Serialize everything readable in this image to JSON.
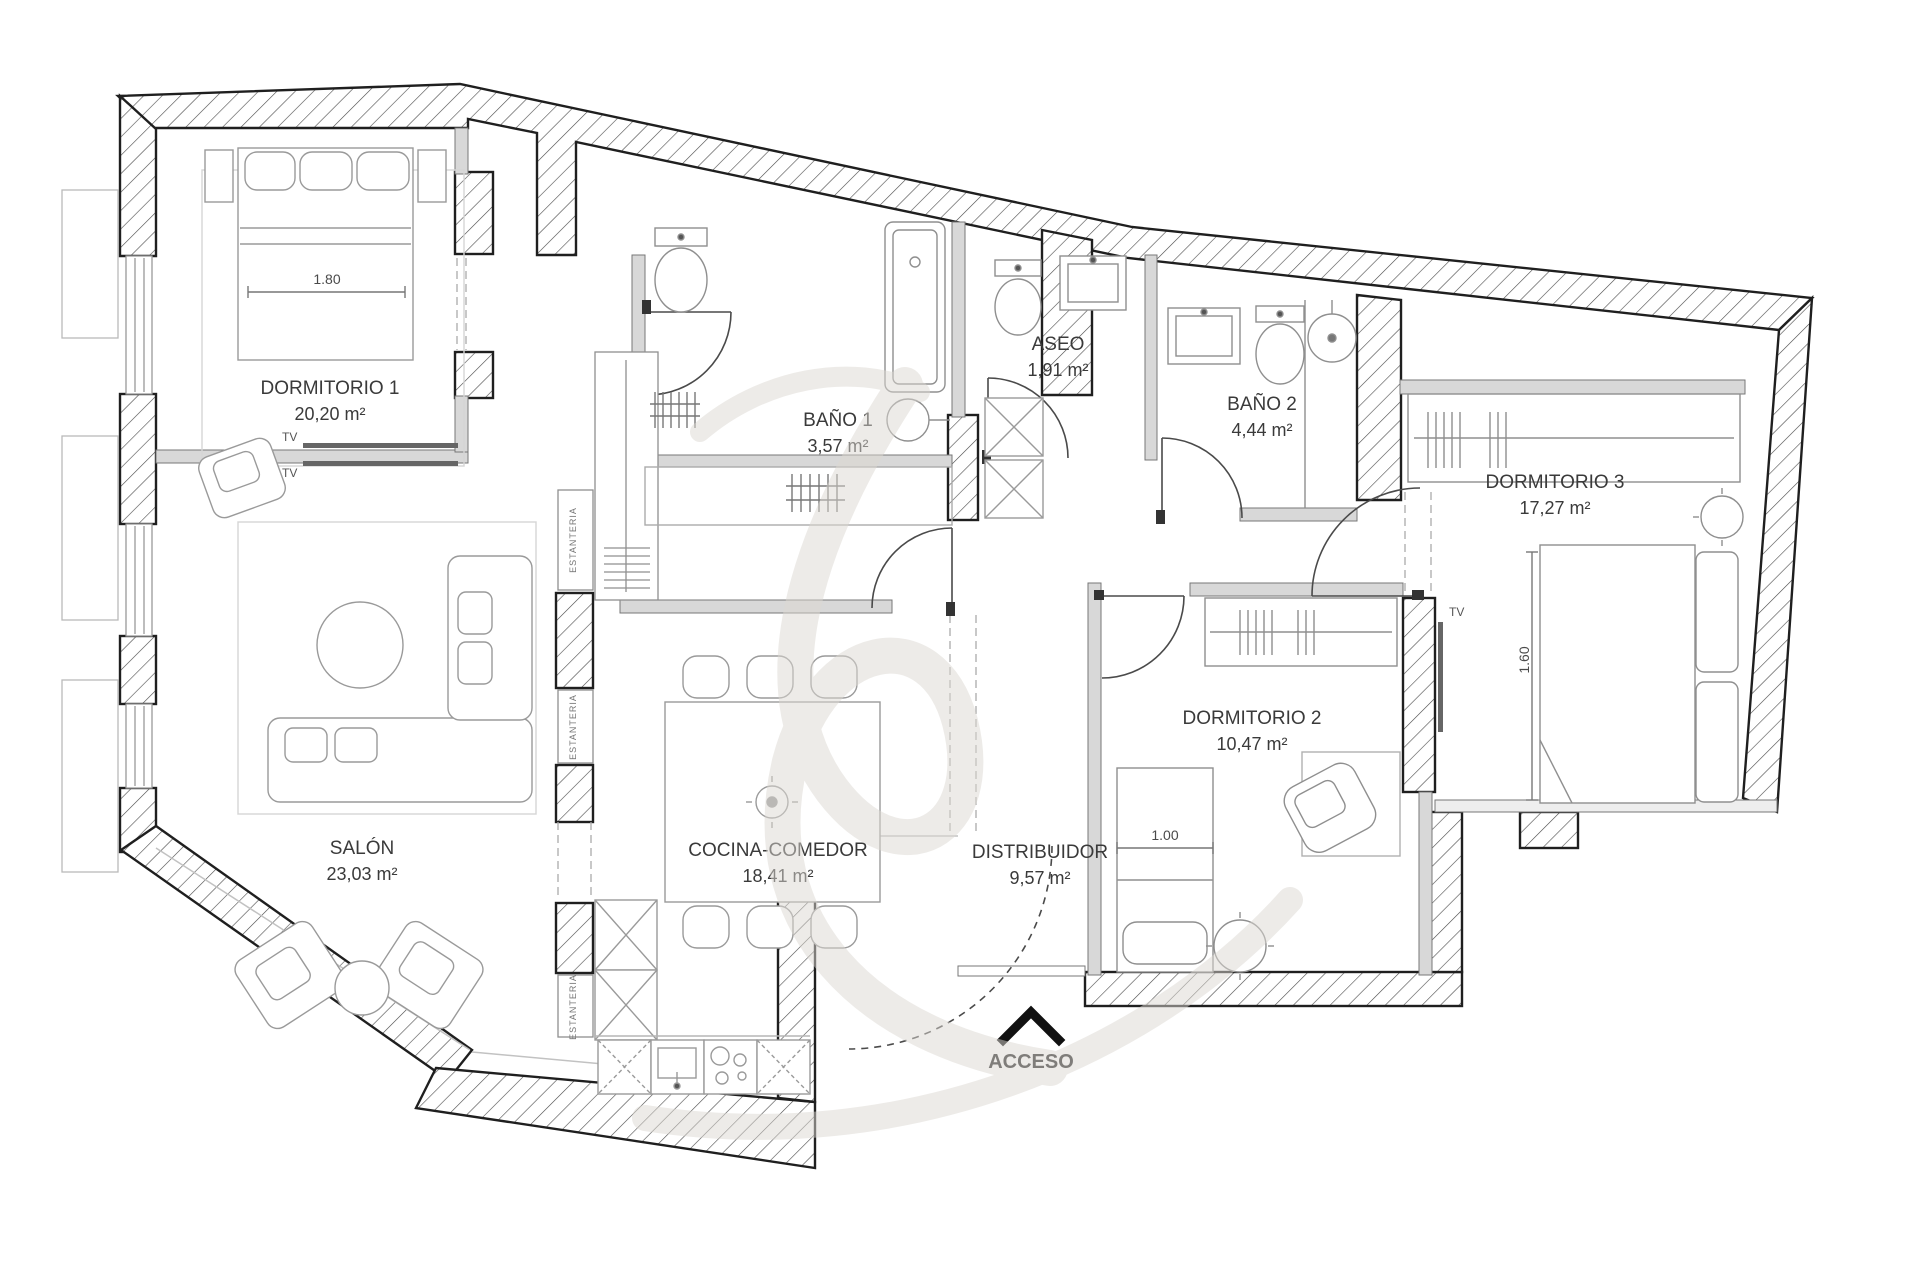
{
  "plan": {
    "rooms": [
      {
        "id": "dormitorio1",
        "name": "DORMITORIO 1",
        "area": "20,20 m²"
      },
      {
        "id": "salon",
        "name": "SALÓN",
        "area": "23,03 m²"
      },
      {
        "id": "bano1",
        "name": "BAÑO 1",
        "area": "3,57 m²"
      },
      {
        "id": "aseo",
        "name": "ASEO",
        "area": "1,91 m²"
      },
      {
        "id": "bano2",
        "name": "BAÑO 2",
        "area": "4,44 m²"
      },
      {
        "id": "dormitorio3",
        "name": "DORMITORIO 3",
        "area": "17,27 m²"
      },
      {
        "id": "dormitorio2",
        "name": "DORMITORIO 2",
        "area": "10,47 m²"
      },
      {
        "id": "cocina",
        "name": "COCINA-COMEDOR",
        "area": "18,41 m²"
      },
      {
        "id": "distribuidor",
        "name": "DISTRIBUIDOR",
        "area": "9,57 m²"
      }
    ],
    "entrance_label": "ACCESO",
    "tv_label": "TV",
    "shelf_label": "ESTANTERIA",
    "dimensions": {
      "dorm1_bed": "1.80",
      "dorm3_bed": "1.60",
      "dorm2_bed": "1.00"
    },
    "colors": {
      "wall_line": "#1f1f1f",
      "hatch_line": "#4a4a4a",
      "interior_wall": "#d8d8d8",
      "furniture_line": "#909090",
      "label_text": "#3a3a3a",
      "watermark": "#dcd8d2"
    }
  }
}
